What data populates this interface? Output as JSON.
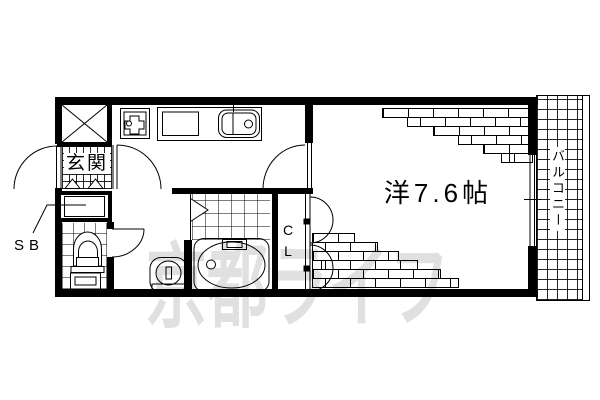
{
  "floorplan": {
    "labels": {
      "entrance": "玄関",
      "shoe_box": "SB",
      "closet": "CL",
      "main_room": "洋7.6帖",
      "balcony": "バルコニー"
    },
    "watermark": "京都ライフ",
    "colors": {
      "line": "#000000",
      "background": "#ffffff",
      "watermark": "#e0e0e0"
    },
    "fixtures": {
      "meter_box": "x-crossed-box",
      "gas_stove": "stove-icon",
      "kitchen_sink": "sink-icon",
      "toilet": "toilet-icon",
      "bathtub": "bathtub-icon",
      "washbasin": "washbasin-icon",
      "bath_door": "folding-door-triangle"
    }
  }
}
